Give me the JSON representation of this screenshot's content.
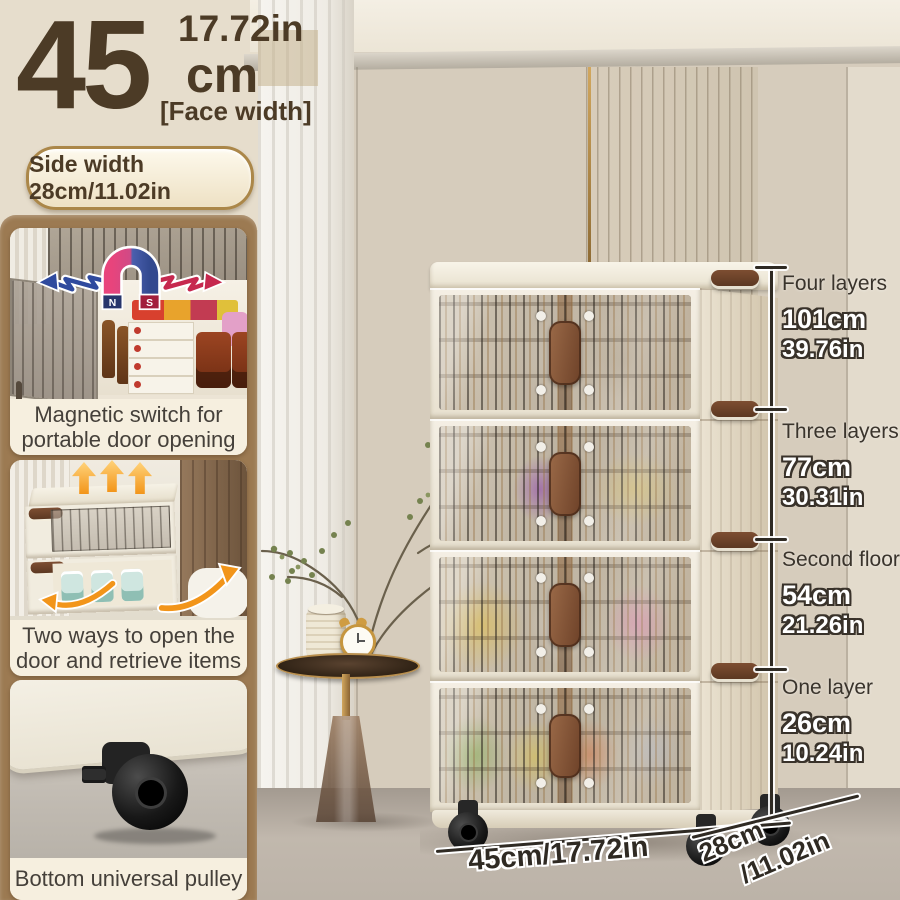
{
  "size_callout": {
    "inches": "17.72in",
    "value": "45",
    "unit": "cm",
    "qualifier": "[Face width]",
    "side_width_badge": "Side width 28cm/11.02in"
  },
  "feature_cards": [
    {
      "caption": "Magnetic switch for portable door opening",
      "magnet_n": "N",
      "magnet_s": "S"
    },
    {
      "caption": "Two ways to open the door and retrieve items"
    },
    {
      "caption": "Bottom universal pulley"
    }
  ],
  "height_annotations": [
    {
      "label": "Four layers",
      "cm": "101cm",
      "inch": "39.76in"
    },
    {
      "label": "Three layers",
      "cm": "77cm",
      "inch": "30.31in"
    },
    {
      "label": "Second floor",
      "cm": "54cm",
      "inch": "21.26in"
    },
    {
      "label": "One layer",
      "cm": "26cm",
      "inch": "10.24in"
    }
  ],
  "base_annotations": {
    "front_width": "45cm/17.72in",
    "side_depth_cm": "28cm",
    "side_depth_in": "/11.02in"
  },
  "colors": {
    "accent_brown": "#4c3b26",
    "panel_brown": "#9c7a52",
    "badge_gold": "#ab8749",
    "magnet_blue": "#2f4a9e",
    "magnet_red": "#c6284e",
    "arrow_orange": "#f2951a",
    "cabinet_cream": "#f1ebdf"
  }
}
